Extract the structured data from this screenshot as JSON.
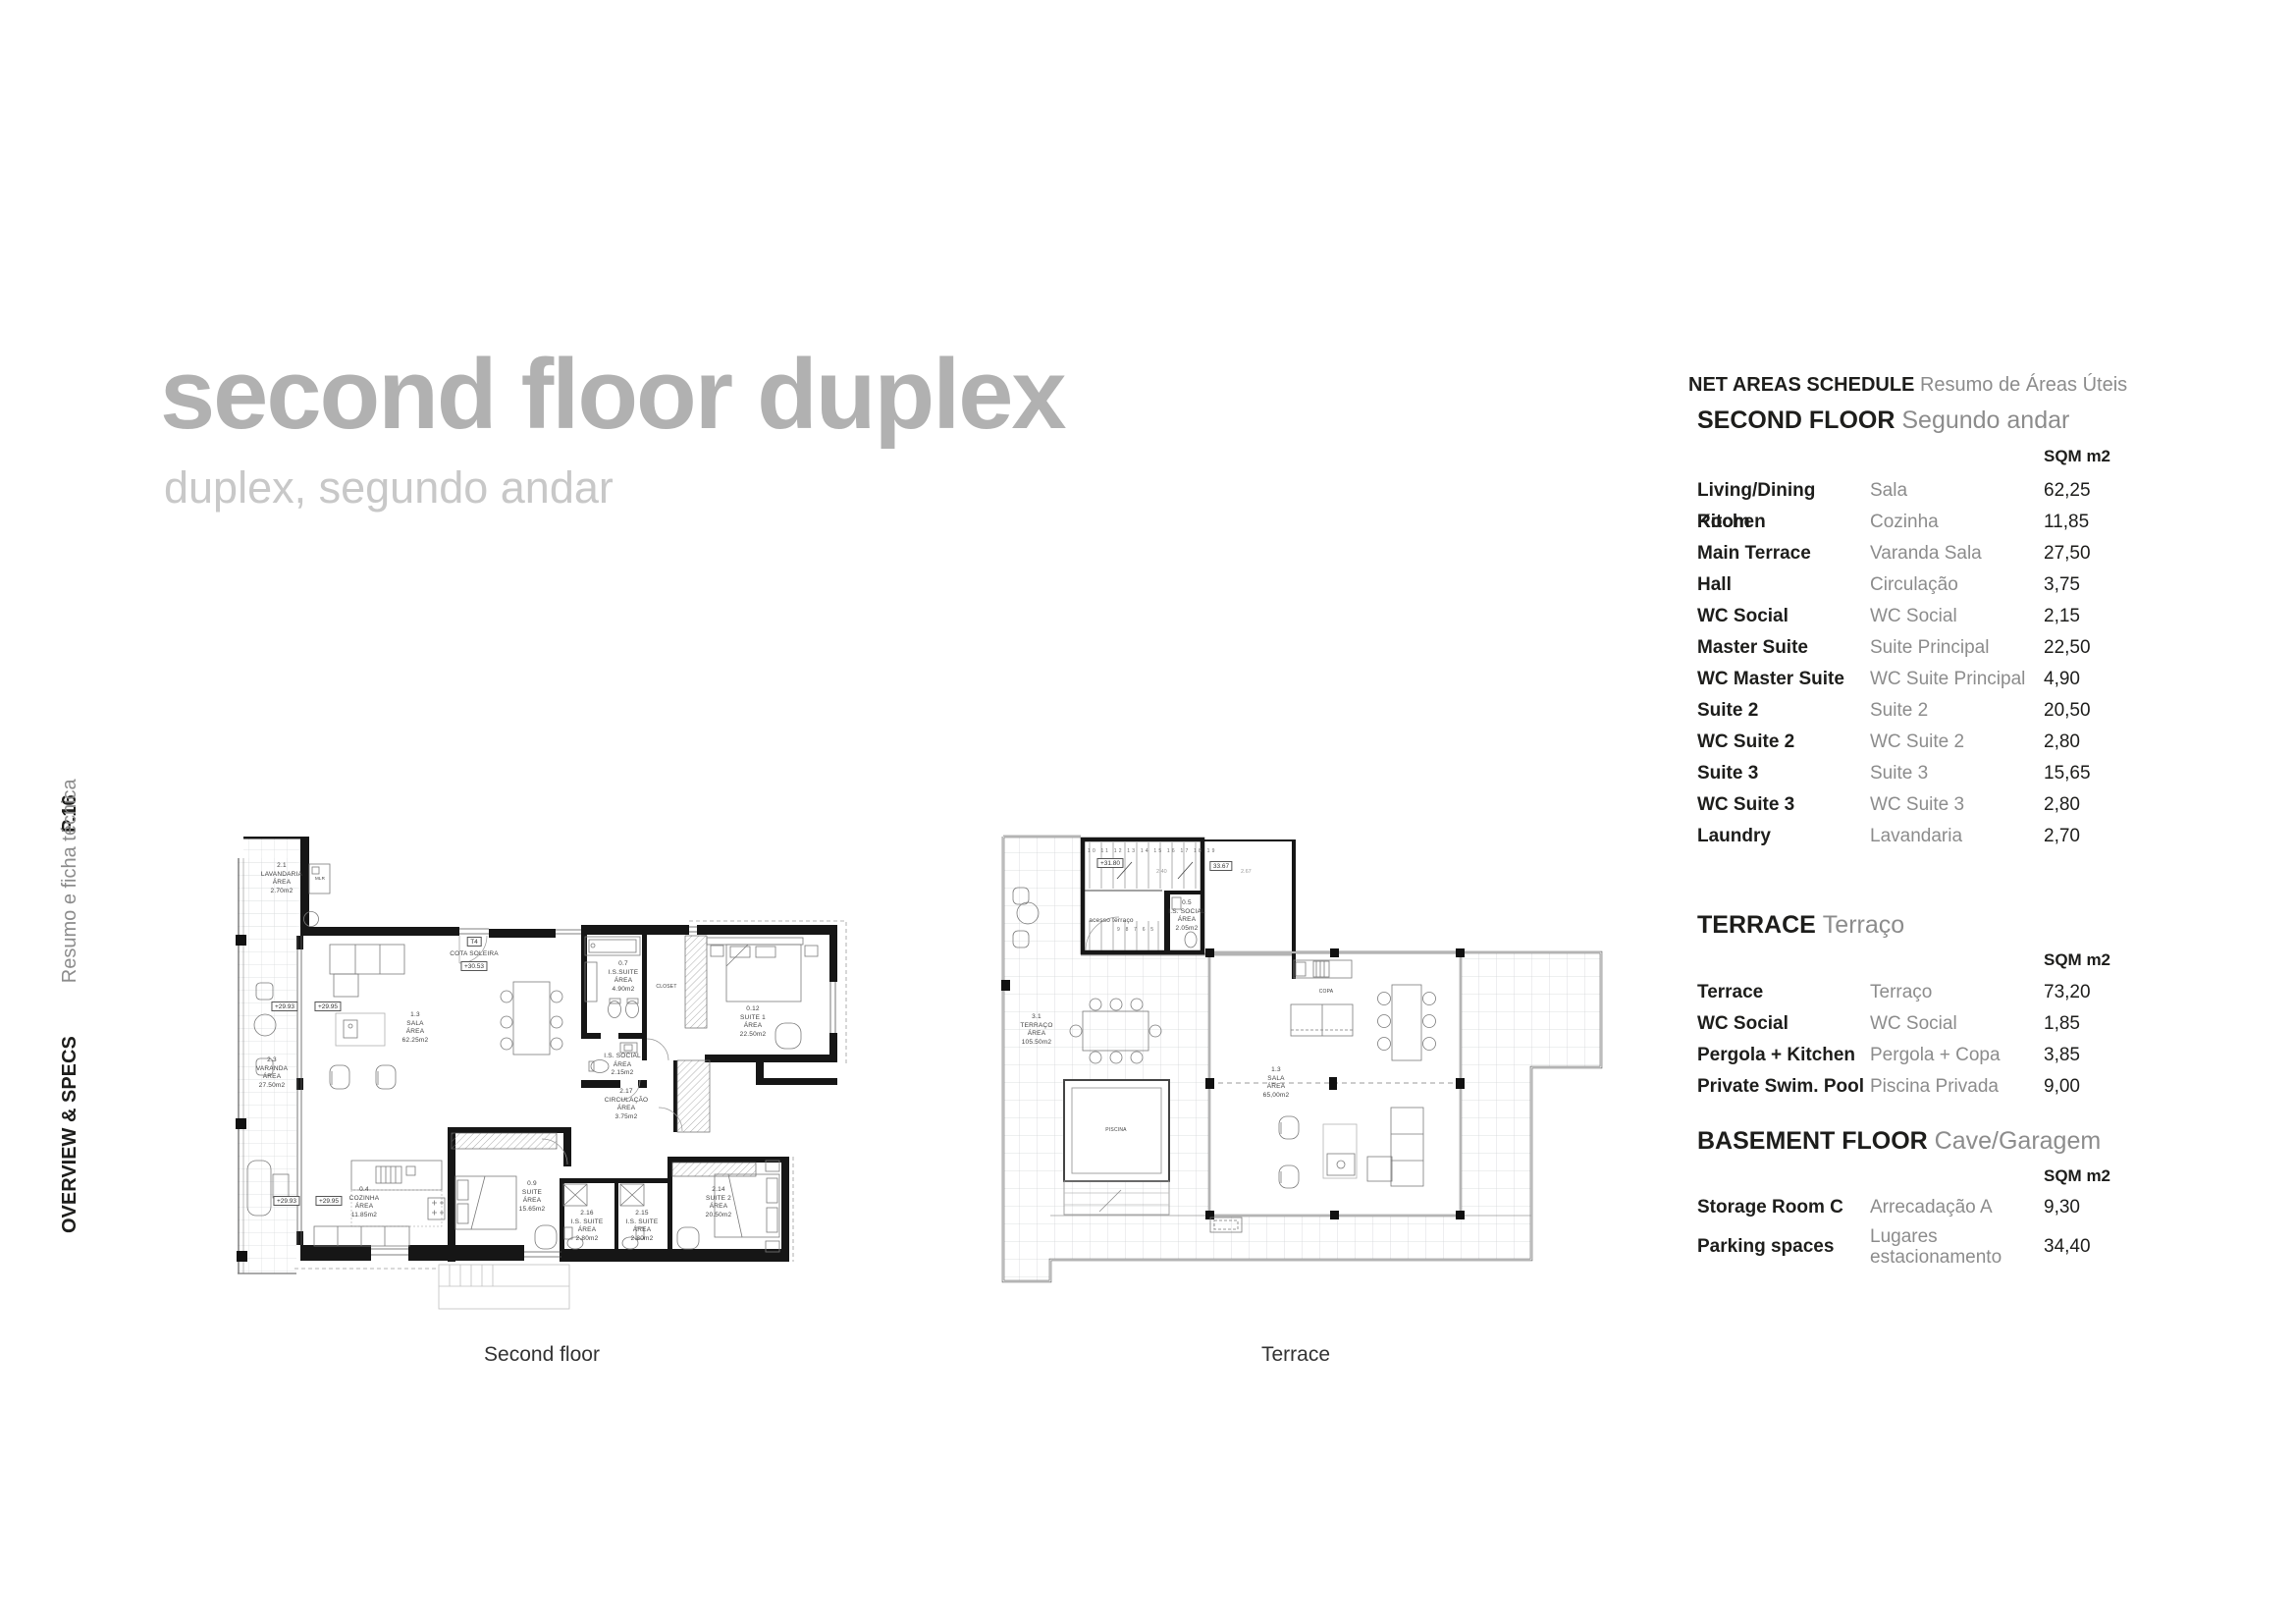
{
  "page": {
    "number": "P.16",
    "sidebar_en": "OVERVIEW & SPECS",
    "sidebar_pt": "Resumo e ficha técnica"
  },
  "header": {
    "title": "second floor duplex",
    "subtitle": "duplex, segundo andar"
  },
  "schedule": {
    "title": "NET AREAS SCHEDULE",
    "title_pt": "Resumo de Áreas Úteis",
    "unit": "SQM m2",
    "sections": [
      {
        "name": "SECOND FLOOR",
        "name_pt": "Segundo andar",
        "rows": [
          {
            "en": "Living/Dining Room",
            "pt": "Sala",
            "sqm": "62,25"
          },
          {
            "en": "Kitchen",
            "pt": "Cozinha",
            "sqm": "11,85"
          },
          {
            "en": "Main Terrace",
            "pt": "Varanda Sala",
            "sqm": "27,50"
          },
          {
            "en": "Hall",
            "pt": "Circulação",
            "sqm": "3,75"
          },
          {
            "en": "WC Social",
            "pt": "WC Social",
            "sqm": "2,15"
          },
          {
            "en": "Master Suite",
            "pt": "Suite Principal",
            "sqm": "22,50"
          },
          {
            "en": "WC Master Suite",
            "pt": "WC Suite Principal",
            "sqm": "4,90"
          },
          {
            "en": "Suite 2",
            "pt": "Suite 2",
            "sqm": "20,50"
          },
          {
            "en": "WC Suite 2",
            "pt": "WC Suite 2",
            "sqm": "2,80"
          },
          {
            "en": "Suite 3",
            "pt": "Suite 3",
            "sqm": "15,65"
          },
          {
            "en": "WC Suite 3",
            "pt": "WC Suite 3",
            "sqm": "2,80"
          },
          {
            "en": "Laundry",
            "pt": "Lavandaria",
            "sqm": "2,70"
          }
        ]
      },
      {
        "name": "TERRACE",
        "name_pt": "Terraço",
        "rows": [
          {
            "en": "Terrace",
            "pt": "Terraço",
            "sqm": "73,20"
          },
          {
            "en": "WC Social",
            "pt": "WC Social",
            "sqm": "1,85"
          },
          {
            "en": "Pergola + Kitchen",
            "pt": "Pergola + Copa",
            "sqm": "3,85"
          },
          {
            "en": "Private Swim. Pool",
            "pt": "Piscina Privada",
            "sqm": "9,00"
          }
        ]
      },
      {
        "name": "BASEMENT FLOOR",
        "name_pt": "Cave/Garagem",
        "rows": [
          {
            "en": "Storage Room C",
            "pt": "Arrecadação A",
            "sqm": "9,30"
          },
          {
            "en": "Parking spaces",
            "pt": "Lugares\nestacionamento",
            "sqm": "34,40"
          }
        ]
      }
    ]
  },
  "floorplans": {
    "left": {
      "caption": "Second floor",
      "labels": {
        "lavandaria": "2.1\nLAVANDARIA\nÁREA\n2.70m2",
        "mlr": "MLR",
        "varanda": "2.3\nVARANDA\nÁREA\n27.50m2",
        "sala": "1.3\nSALA\nÁREA\n62.25m2",
        "t4": "T4",
        "cota": "COTA SOLEIRA",
        "cota_val": "+30.53",
        "lvl_a": "+29.93",
        "lvl_b": "+29.95",
        "is_suite": "0.7\nI.S.SUITE\nÁREA\n4.90m2",
        "closet": "CLOSET",
        "suite1": "0.12\nSUITE 1\nÁREA\n22.50m2",
        "is_social": "I.S. SOCIAL\nÁREA\n2.15m2",
        "circulacao": "2.17\nCIRCULAÇÃO\nÁREA\n3.75m2",
        "cozinha": "0.4\nCOZINHA\nÁREA\n11.85m2",
        "suite": "0.9\nSUITE\nÁREA\n15.65m2",
        "is_suite_a": "2.16\nI.S. SUITE\nÁREA\n2.80m2",
        "is_suite_b": "2.15\nI.S. SUITE\nÁREA\n2.80m2",
        "suite2": "2.14\nSUITE 2\nÁREA\n20.50m2"
      }
    },
    "right": {
      "caption": "Terrace",
      "labels": {
        "lvl": "+31.80",
        "cota": "33.67",
        "d1": "2.40",
        "d2": "2.67",
        "steps_up": "10 11 12 13 14 15 16 17 18 19",
        "steps_dn": "9 8 7 6 5",
        "acesso": "acesso terraço",
        "is_social": "0.5\nI.S. SOCIAL\nÁREA\n2.05m2",
        "terraco": "3.1\nTERRAÇO\nÁREA\n105.50m2",
        "sala": "1.3\nSALA\nÁREA\n65,00m2",
        "copa": "COPA",
        "piscina": "PISCINA"
      }
    }
  }
}
